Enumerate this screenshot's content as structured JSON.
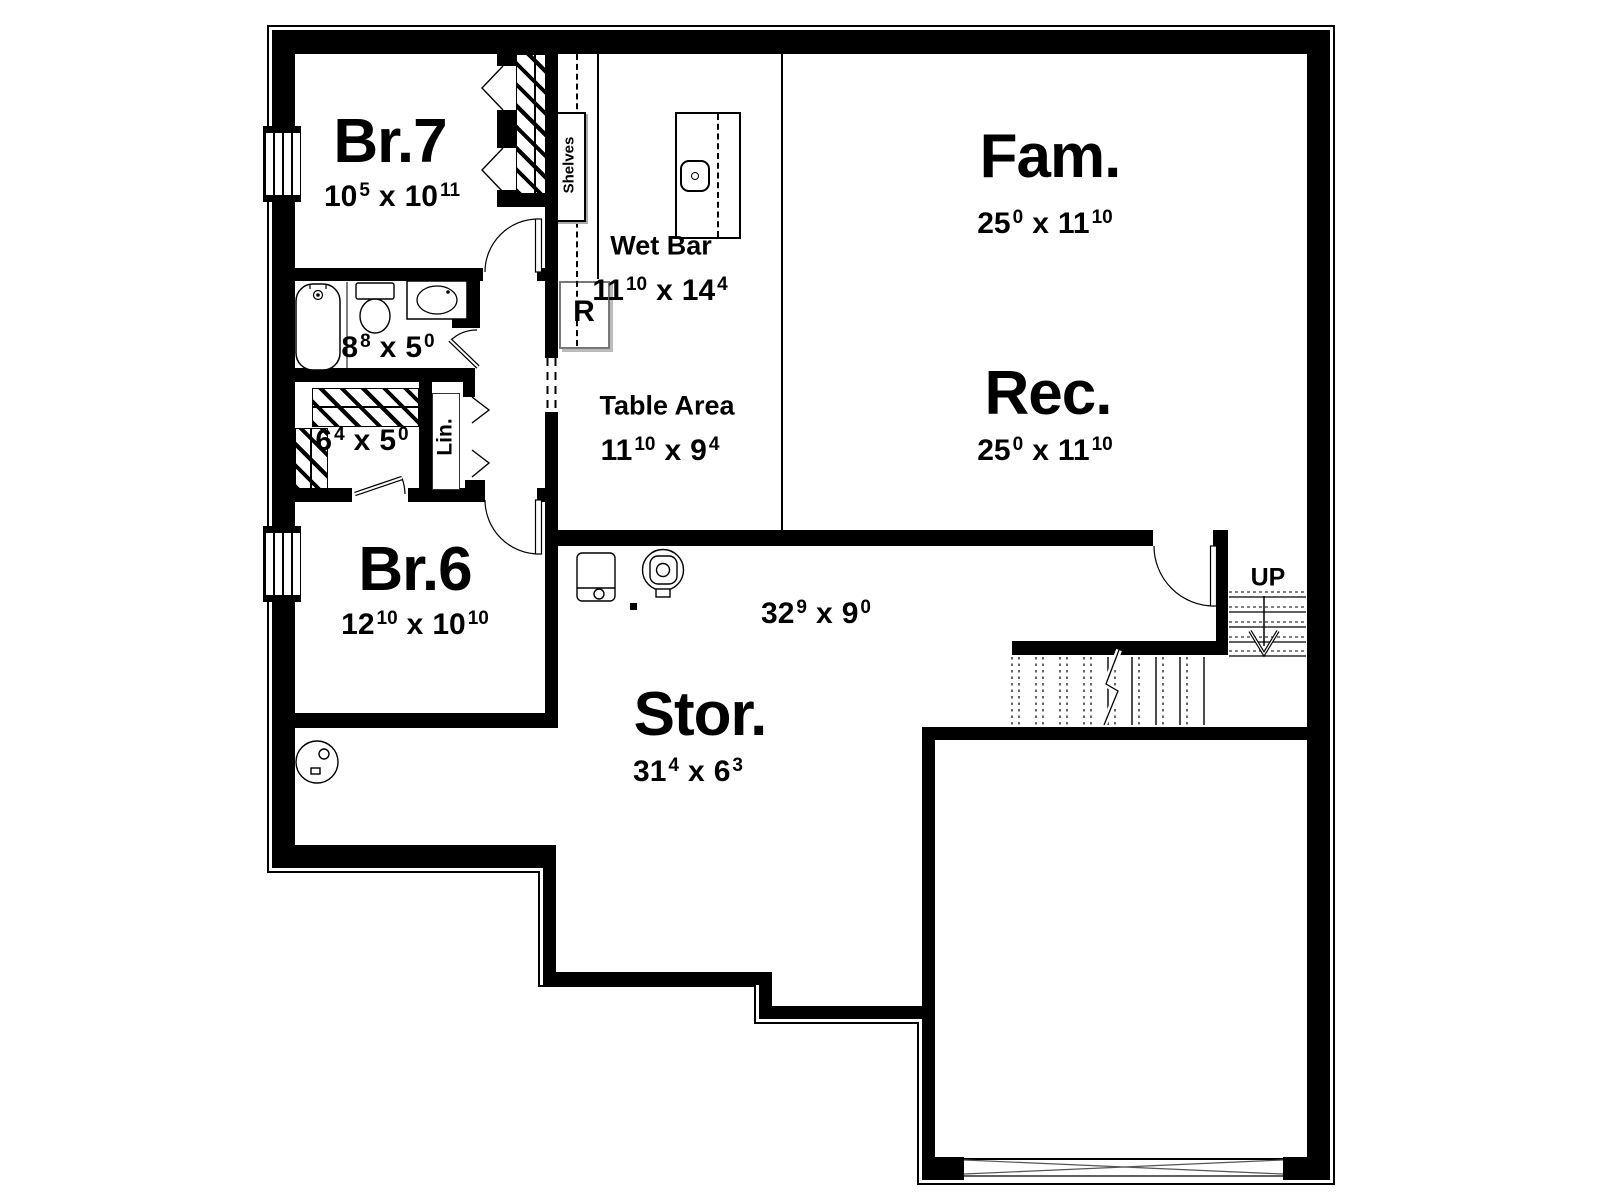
{
  "plan": {
    "title": "Basement floor plan",
    "dim_sep": "x",
    "colors": {
      "wall": "#000000",
      "background": "#ffffff",
      "shadow": "#bbbbbb"
    },
    "rooms": {
      "br7": {
        "name": "Br.7",
        "a": "10",
        "as": "5",
        "b": "10",
        "bs": "11"
      },
      "bath": {
        "a": "8",
        "as": "8",
        "b": "5",
        "bs": "0"
      },
      "closet": {
        "a": "6",
        "as": "4",
        "b": "5",
        "bs": "0"
      },
      "br6": {
        "name": "Br.6",
        "a": "12",
        "as": "10",
        "b": "10",
        "bs": "10"
      },
      "wetbar": {
        "name": "Wet Bar",
        "a": "11",
        "as": "10",
        "b": "14",
        "bs": "4"
      },
      "table": {
        "name": "Table Area",
        "a": "11",
        "as": "10",
        "b": "9",
        "bs": "4"
      },
      "fam": {
        "name": "Fam.",
        "a": "25",
        "as": "0",
        "b": "11",
        "bs": "10"
      },
      "rec": {
        "name": "Rec.",
        "a": "25",
        "as": "0",
        "b": "11",
        "bs": "10"
      },
      "stor": {
        "name": "Stor.",
        "a": "31",
        "as": "4",
        "b": "6",
        "bs": "3"
      },
      "stor_upper": {
        "a": "32",
        "as": "9",
        "b": "9",
        "bs": "0"
      }
    },
    "fixtures": {
      "shelves": "Shelves",
      "linen": "Lin.",
      "refrigerator": "R",
      "stairs_up": "UP"
    }
  }
}
